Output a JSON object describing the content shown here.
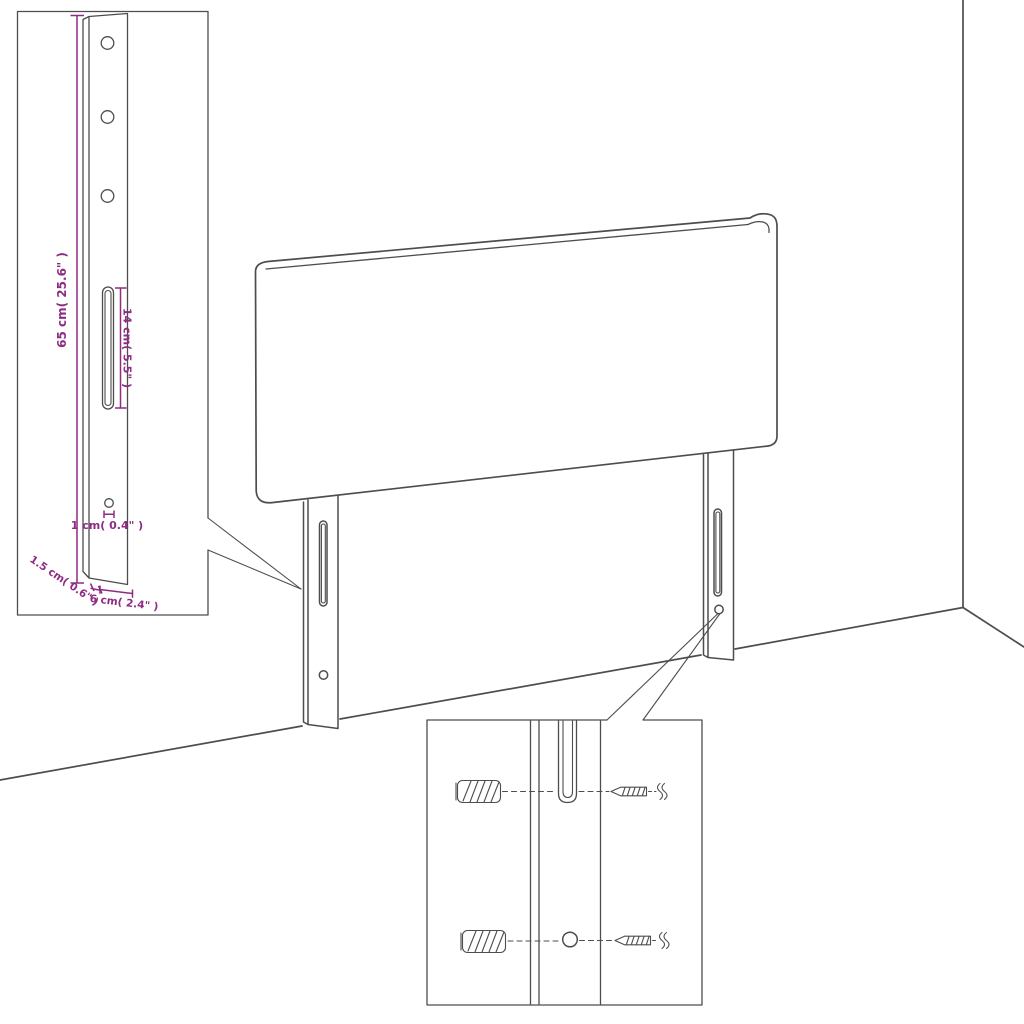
{
  "diagram": {
    "type": "product-dimension-diagram",
    "subject": "headboard with mounting legs",
    "colors": {
      "line": "#4d4d4d",
      "dimension": "#8e2c83",
      "background": "#ffffff"
    },
    "leg_detail": {
      "dim_height": "65 cm( 25.6\" )",
      "dim_slot": "14 cm( 5.5\" )",
      "dim_hole": "1 cm( 0.4\" )",
      "dim_thickness": "1.5 cm( 0.6\" )",
      "dim_width": "6 cm( 2.4\" )"
    },
    "mounting_detail": {
      "parts": [
        "wall-plug",
        "screw",
        "slot",
        "round-hole"
      ]
    }
  }
}
